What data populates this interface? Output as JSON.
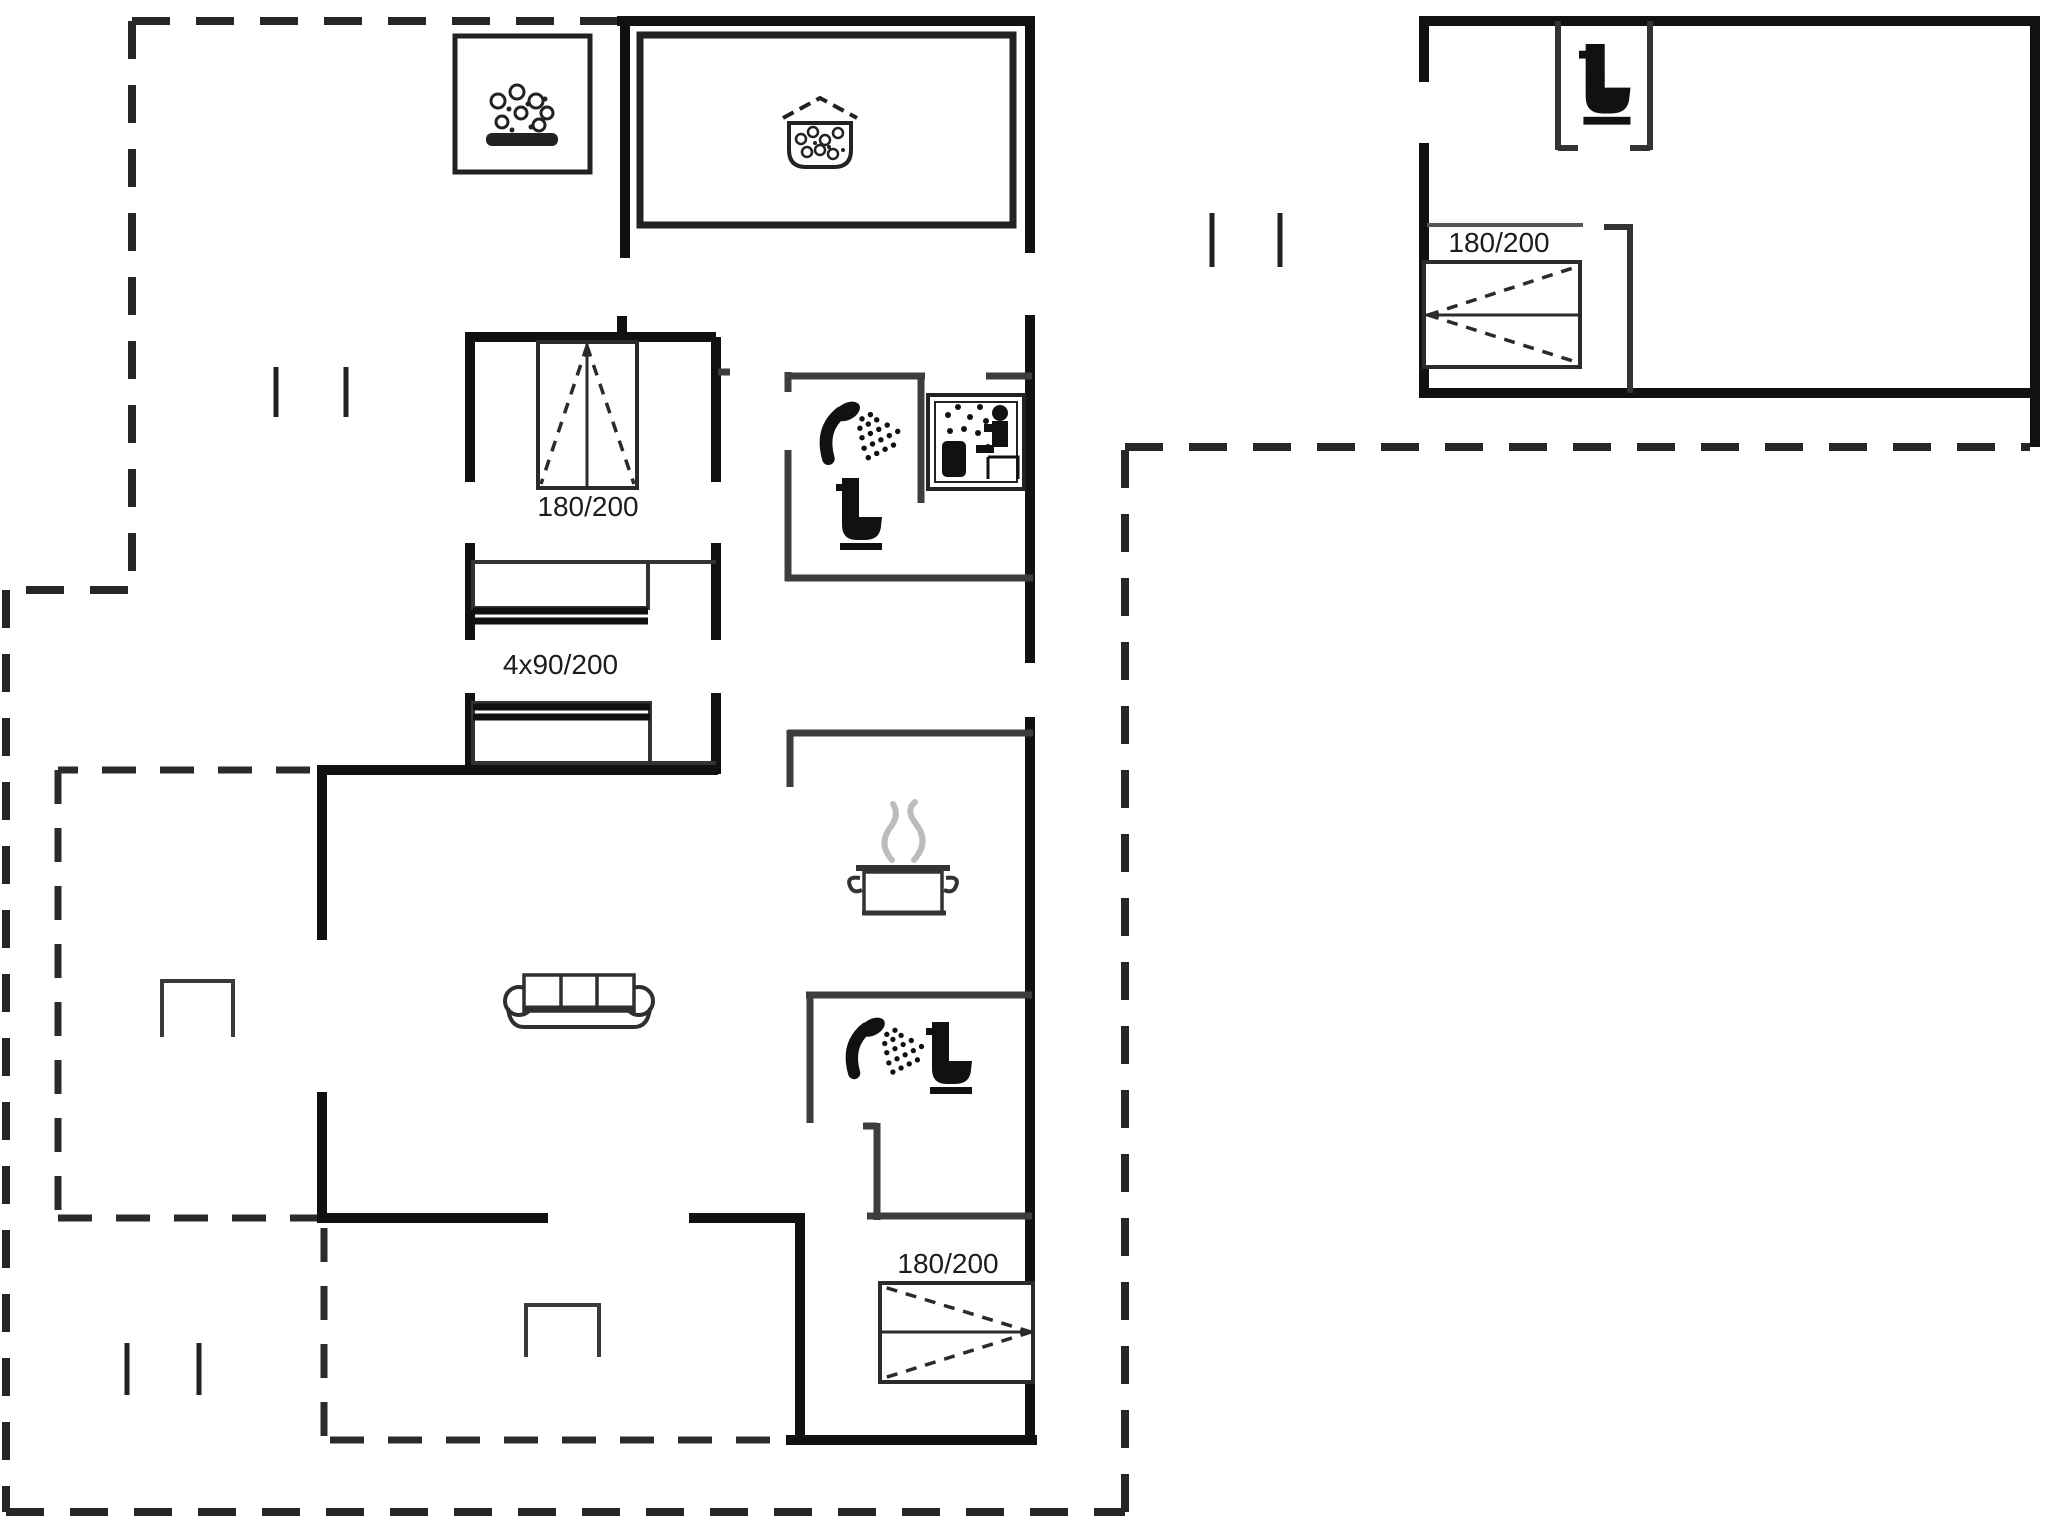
{
  "plan": {
    "type": "holiday-house-floor-plan",
    "labels": {
      "bedroom_bed": "180/200",
      "bunk_beds": "4x90/200",
      "south_bedroom_bed": "180/200",
      "annex_bed": "180/200"
    },
    "icons": [
      "hot-tub-icon",
      "spa-bath-icon",
      "shower-icon",
      "toilet-icon",
      "sauna-icon",
      "cooking-pot-icon",
      "sofa-icon",
      "double-bed-icon",
      "bunk-bed-icon"
    ],
    "colors": {
      "exterior_wall": "#111111",
      "interior_wall": "#3d3d3d",
      "boundary_dash": "#262626",
      "furniture": "#2b2b2b",
      "steam": "#bcbcbc",
      "background": "#ffffff"
    }
  }
}
